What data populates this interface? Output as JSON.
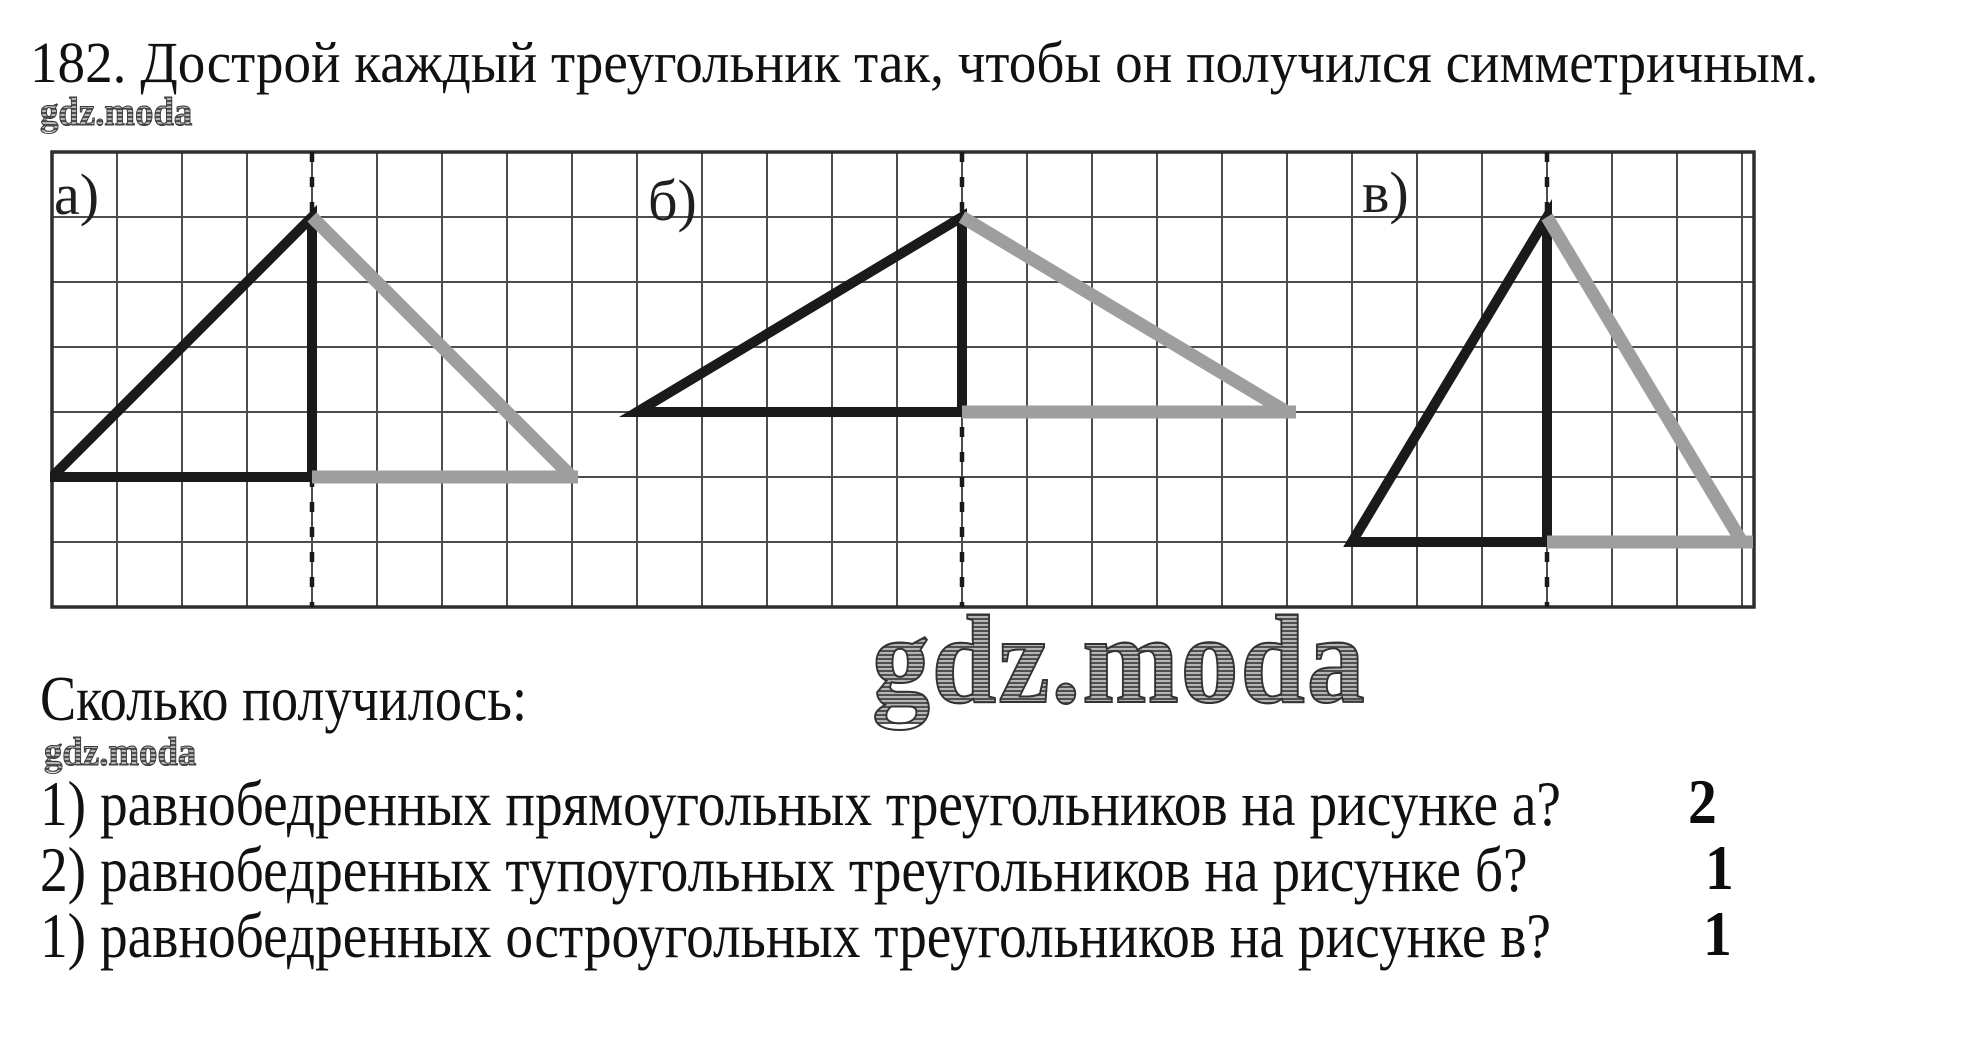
{
  "document": {
    "title": "182. Дострой каждый треугольник так, чтобы он получился симметричным.",
    "subheading": "Сколько получилось:",
    "watermark_small_top": "gdz.moda",
    "watermark_small_mid": "gdz.moda",
    "watermark_large": "gdz.moda"
  },
  "figure": {
    "labels": [
      {
        "text": "а)"
      },
      {
        "text": "б)"
      },
      {
        "text": "в)"
      }
    ],
    "grid": {
      "width": 1702,
      "height": 455,
      "cell": 65,
      "cols": 26,
      "rows": 7
    },
    "symmetry_axes_x": [
      260,
      910,
      1495
    ],
    "triangles": [
      {
        "name": "a",
        "black_outline": [
          [
            0,
            325
          ],
          [
            260,
            65
          ],
          [
            260,
            325
          ]
        ],
        "gray_segments": [
          [
            [
              260,
              65
            ],
            [
              520,
              325
            ]
          ],
          [
            [
              260,
              325
            ],
            [
              526,
              325
            ]
          ]
        ]
      },
      {
        "name": "b",
        "black_outline": [
          [
            585,
            260
          ],
          [
            910,
            65
          ],
          [
            910,
            260
          ]
        ],
        "gray_segments": [
          [
            [
              910,
              65
            ],
            [
              1235,
              260
            ]
          ],
          [
            [
              910,
              260
            ],
            [
              1244,
              260
            ]
          ]
        ]
      },
      {
        "name": "v",
        "black_outline": [
          [
            1300,
            390
          ],
          [
            1495,
            65
          ],
          [
            1495,
            390
          ]
        ],
        "gray_segments": [
          [
            [
              1495,
              65
            ],
            [
              1690,
              390
            ]
          ],
          [
            [
              1495,
              390
            ],
            [
              1701,
              390
            ]
          ]
        ]
      }
    ],
    "colors": {
      "grid_line": "#4d4d4d",
      "grid_border": "#2f2f2f",
      "triangle_black": "#1a1a1a",
      "triangle_gray": "#9e9e9e",
      "dashed_axis": "#1a1a1a"
    }
  },
  "questions": [
    {
      "text": "1) равнобедренных прямоугольных треугольников на рисунке а?",
      "answer": "2"
    },
    {
      "text": "2) равнобедренных тупоугольных треугольников на рисунке б?",
      "answer": "1"
    },
    {
      "text": "1) равнобедренных остроугольных треугольников на рисунке в?",
      "answer": "1"
    }
  ]
}
